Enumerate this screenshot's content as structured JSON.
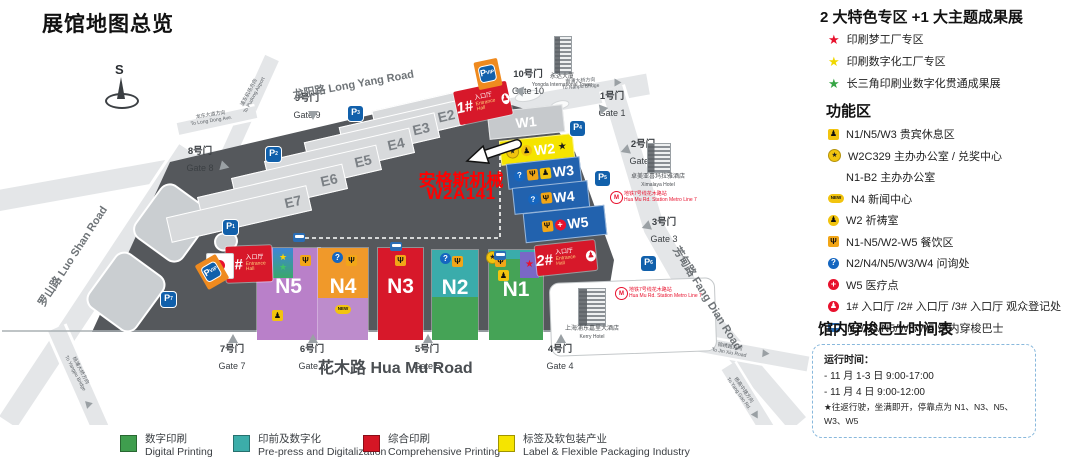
{
  "title": "展馆地图总览",
  "compass": {
    "label": "S"
  },
  "annotation": {
    "company": "安格斯机械",
    "booth": "W2A141"
  },
  "map": {
    "halls_e": [
      "E1",
      "E2",
      "E3",
      "E4",
      "E5",
      "E6",
      "E7"
    ],
    "halls_w": [
      "W1",
      "W2",
      "W3",
      "W4",
      "W5"
    ],
    "halls_n": [
      "N5",
      "N4",
      "N3",
      "N2",
      "N1"
    ],
    "entrances": [
      {
        "num": "1#",
        "cn": "入口厅",
        "en": "Entrance Hall"
      },
      {
        "num": "2#",
        "cn": "入口厅",
        "en": "Entrance Hall"
      },
      {
        "num": "3#",
        "cn": "入口厅",
        "en": "Entrance Hall"
      }
    ],
    "gates": [
      {
        "cn": "1号门",
        "en": "Gate 1"
      },
      {
        "cn": "2号门",
        "en": "Gate 2"
      },
      {
        "cn": "3号门",
        "en": "Gate 3"
      },
      {
        "cn": "4号门",
        "en": "Gate 4"
      },
      {
        "cn": "5号门",
        "en": "Gate 5"
      },
      {
        "cn": "6号门",
        "en": "Gate 6"
      },
      {
        "cn": "7号门",
        "en": "Gate 7"
      },
      {
        "cn": "8号门",
        "en": "Gate 8"
      },
      {
        "cn": "9号门",
        "en": "Gate 9"
      },
      {
        "cn": "10号门",
        "en": "Gate 10"
      }
    ],
    "roads": {
      "longyang": {
        "cn": "龙阳路",
        "en": "Long Yang Road"
      },
      "luoshan": {
        "cn": "罗山路",
        "en": "Luo Shan Road"
      },
      "huamu": {
        "cn": "花木路",
        "en": "Hua Mu Road"
      },
      "fangdian": {
        "cn": "芳甸路",
        "en": "Fang Dian Road"
      }
    },
    "directions": {
      "airport": {
        "cn": "浦东机场方向",
        "en": "To Pudong Airport"
      },
      "longdong": {
        "cn": "龙东大道方向",
        "en": "To Long Dong Ave."
      },
      "nanpu": {
        "cn": "南浦大桥方向",
        "en": "To Nanpu Bridge"
      },
      "yangpu": {
        "cn": "杨浦大桥方向",
        "en": "To Yangpu Bridge"
      },
      "jinxiu": {
        "cn": "锦绣路方向",
        "en": "To Jin Xiu Road"
      },
      "yanggao": {
        "cn": "杨高中路方向",
        "en": "To Yang Gao Rd."
      }
    },
    "parking_label": "P",
    "parking_subs": [
      "3",
      "2",
      "1",
      "7",
      "4",
      "5",
      "6",
      "VIP",
      "VIP"
    ],
    "landmarks": [
      {
        "cn": "永达大厦",
        "en": "Yongda International Tower"
      },
      {
        "cn": "卓美亚喜玛拉雅酒店",
        "en": "Ximalaya Hotel"
      },
      {
        "cn": "上海浦东嘉里大酒店",
        "en": "Kerry Hotel"
      }
    ],
    "metro": {
      "cn": "地铁7号线花木路站",
      "en": "Hua Mu Rd. Station Metro Line 7"
    }
  },
  "sidebar": {
    "special_title": "2 大特色专区 +1 大主题成果展",
    "special_zones": [
      {
        "color": "#e8112d",
        "label": "印刷梦工厂专区"
      },
      {
        "color": "#f0d800",
        "label": "印刷数字化工厂专区"
      },
      {
        "color": "#35a544",
        "label": "长三角印刷业数字化贯通成果展"
      }
    ],
    "functions_title": "功能区",
    "functions": [
      {
        "icon": "vip",
        "label": "N1/N5/W3 贵宾休息区"
      },
      {
        "icon": "starc",
        "label": "W2C329 主办办公室 / 兑奖中心"
      },
      {
        "icon": "",
        "label": "N1-B2 主办办公室"
      },
      {
        "icon": "new",
        "label": "N4 新闻中心"
      },
      {
        "icon": "prayer",
        "label": "W2 祈祷室"
      },
      {
        "icon": "fork",
        "label": "N1-N5/W2-W5 餐饮区"
      },
      {
        "icon": "q",
        "label": "N2/N4/N5/W3/W4 问询处"
      },
      {
        "icon": "med",
        "label": "W5 医疗点"
      },
      {
        "icon": "reg",
        "label": "1# 入口厅 /2# 入口厅 /3# 入口厅 观众登记处"
      },
      {
        "icon": "bus",
        "label": "N1/N3/N5/W3/W5 馆内穿梭巴士"
      }
    ],
    "shuttle_title": "馆内穿梭巴士时间表",
    "shuttle": {
      "heading": "运行时间：",
      "lines": [
        "- 11 月 1-3 日 9:00-17:00",
        "- 11 月 4 日 9:00-12:00",
        "★往返行驶，坐满即开，停靠点为 N1、N3、N5、W3、W5"
      ]
    }
  },
  "legend": [
    {
      "color": "#3f9e4e",
      "cn": "数字印刷",
      "en": "Digital Printing"
    },
    {
      "color": "#3cada9",
      "cn": "印前及数字化",
      "en": "Pre-press and Digitalization"
    },
    {
      "color": "#d51625",
      "cn": "综合印刷",
      "en": "Comprehensive Printing"
    },
    {
      "color": "#f5e400",
      "cn": "标签及软包装产业",
      "en": "Label & Flexible Packaging Industry"
    }
  ]
}
